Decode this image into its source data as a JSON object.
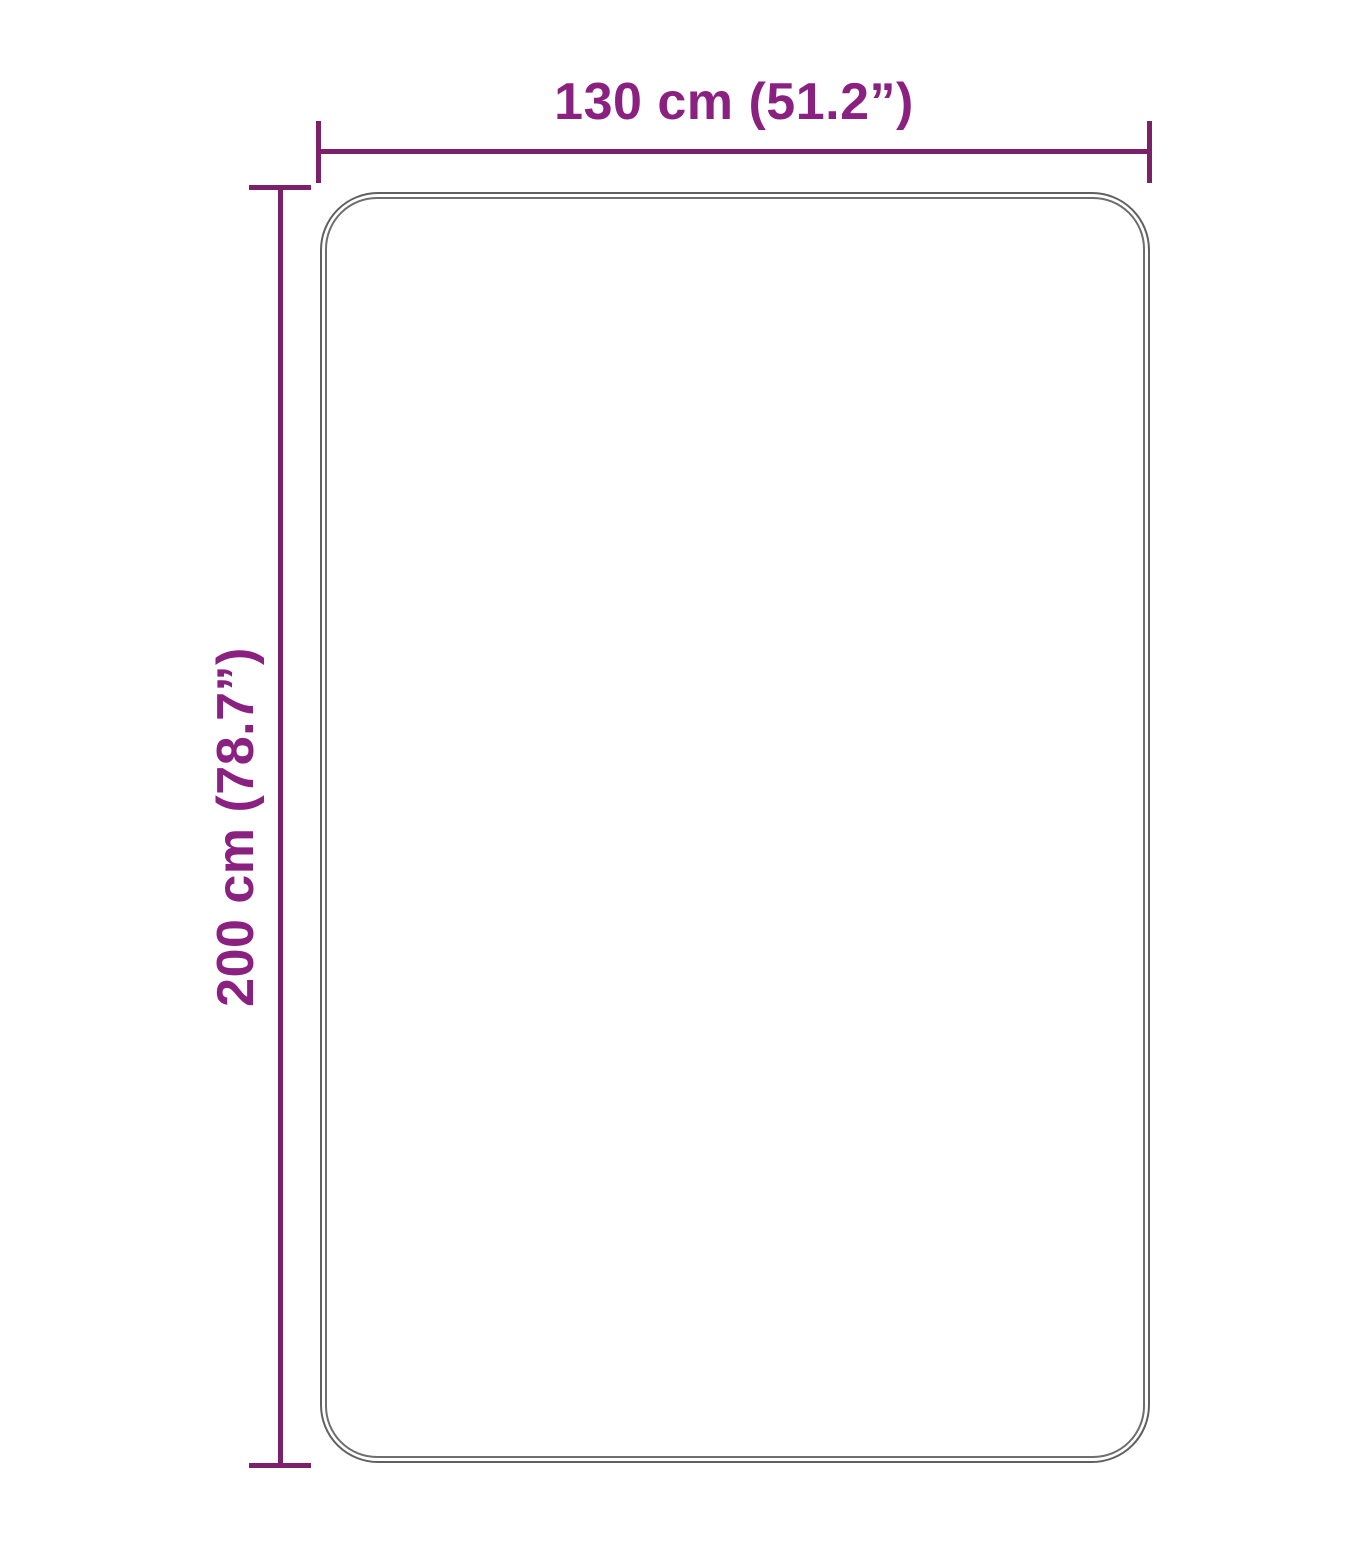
{
  "diagram": {
    "type": "product-dimension-diagram",
    "shape": "rounded-rectangle",
    "width_dimension": {
      "label": "130 cm (51.2”)",
      "value_cm": 130,
      "value_inches": 51.2
    },
    "height_dimension": {
      "label": "200 cm (78.7”)",
      "value_cm": 200,
      "value_inches": 78.7
    },
    "colors": {
      "dimension_line": "#7b2169",
      "dimension_label": "#8a2180",
      "outline_outer": "#606060",
      "outline_inner": "#6e6e6e",
      "background": "#ffffff"
    }
  }
}
